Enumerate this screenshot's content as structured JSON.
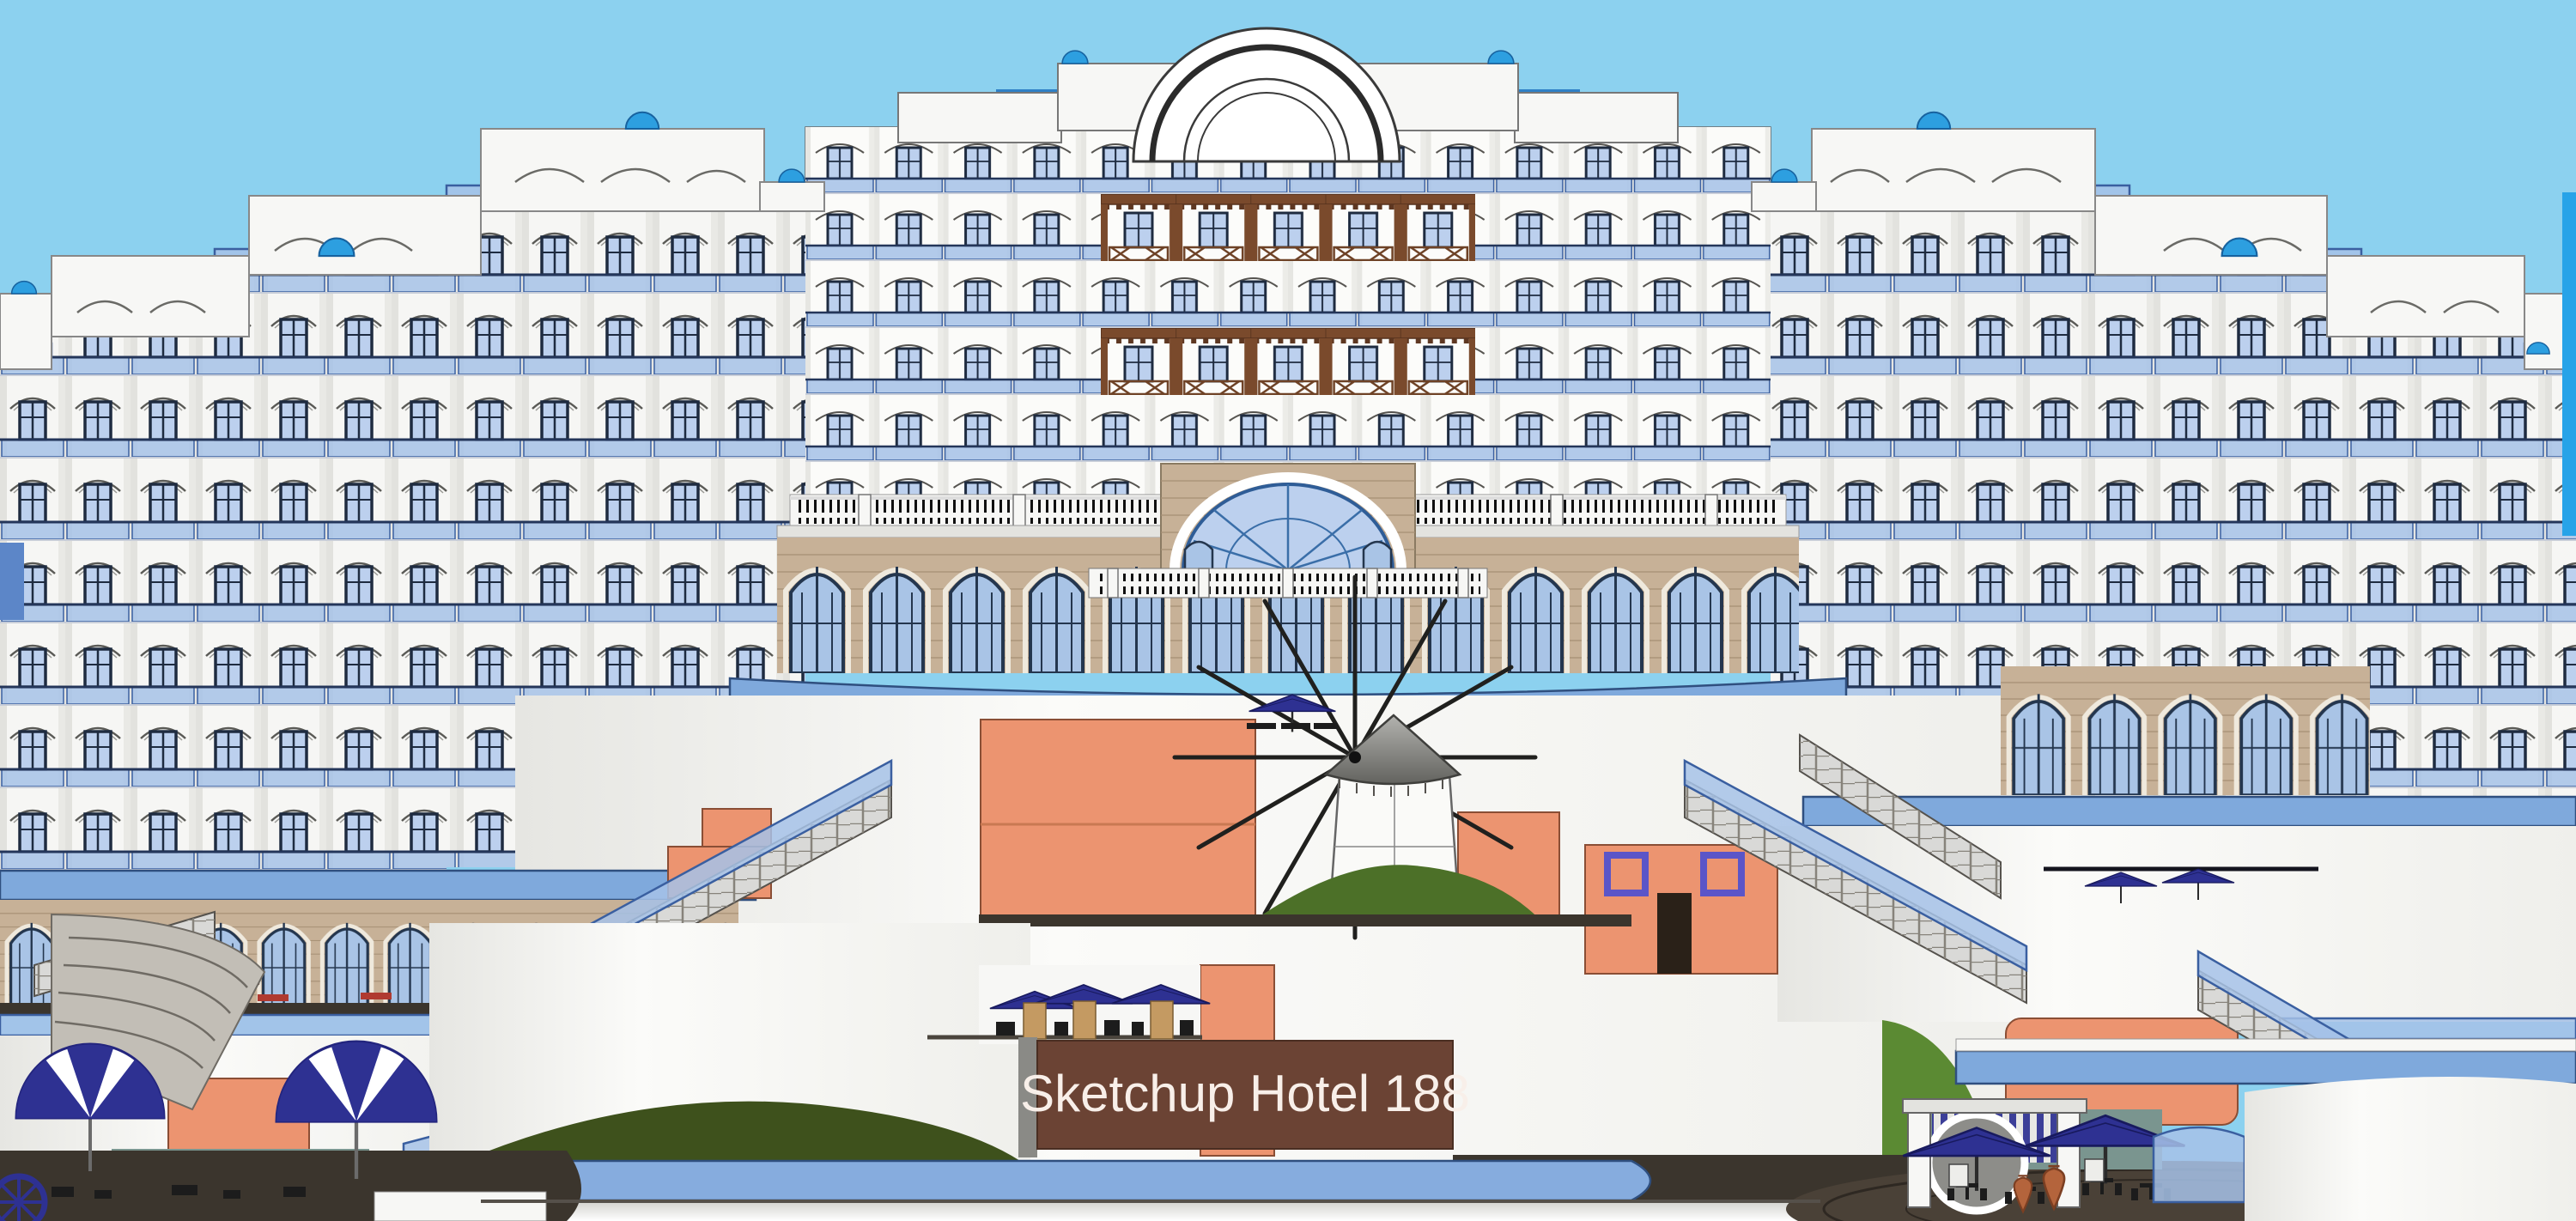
{
  "sign": {
    "label": "Sketchup Hotel 188"
  },
  "scene": {
    "type": "architectural-elevation-render",
    "subject": "terraced seaside resort hotel with balconied wings, central pediment, brick arcade, greek windmill, grand staircases, pool terraces and cafe pergola"
  },
  "colors": {
    "sky": "#8CD1EF",
    "roofBand": "#2E80C6",
    "facade": "#F7F7F5",
    "facadeShade": "#E3E3DF",
    "frame": "#1E2B40",
    "glass": "#BCD0EE",
    "glassDeep": "#A9C4E6",
    "railGlass": "#A6C2E8",
    "railEdge": "#3A5FA0",
    "brick": "#C7B197",
    "brickLine": "#A68F74",
    "wood": "#7A4A2C",
    "salmon": "#EC9470",
    "salmonEdge": "#8A4E35",
    "grass": "#4C7028",
    "grassDark": "#3E511C",
    "grassBright": "#5B8A33",
    "domeBlue": "#2D9FE0",
    "domeEdge": "#17629F",
    "walkway": "#7FA9DC",
    "walkwayEdge": "#2F4F7F",
    "channel": "#86ACDE",
    "stone": "#C2BEB6",
    "stoneEdge": "#6F6B64",
    "stepFill": "#D9D9D7",
    "umbrellaNavy": "#2E3192",
    "umbrellaEdge": "#181A5E",
    "maroon": "#7E3B34",
    "teal": "#7A958F",
    "patio": "#4A4137",
    "signBg": "#6B4334",
    "signEdge": "#4A2E22",
    "signText": "#F8EFE9",
    "terracotta": "#B4643C",
    "sand": "#C49A62",
    "darkFloor": "#3B352D",
    "cyanEdge": "#27A3E8"
  }
}
